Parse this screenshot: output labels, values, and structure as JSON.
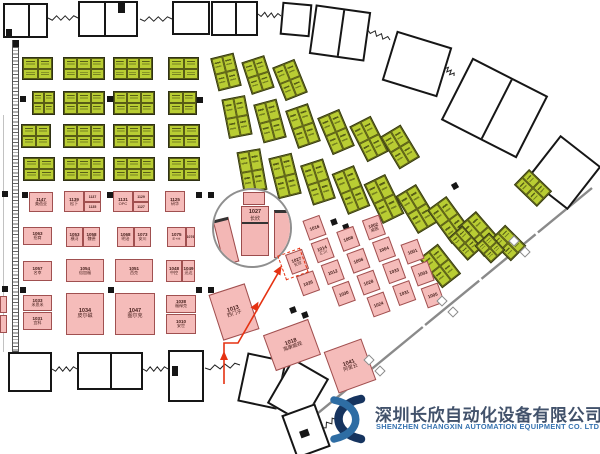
{
  "company": {
    "name_cn": "深圳长欣自动化设备有限公司",
    "name_en": "SHENZHEN CHANGXIN AUTOMATION EQUIPMENT CO. LTD"
  },
  "colors": {
    "green_booth": "#b9cd33",
    "pink_booth": "#f5bcba",
    "route_red": "#e53212",
    "wall_black": "#161616",
    "barrier_gray": "#8a8a8a",
    "logo_navy": "#16345f",
    "logo_blue": "#2e6da4"
  },
  "magnifier": {
    "cx": 252,
    "cy": 228,
    "r": 40,
    "booth_num": "1027",
    "booth_name": "长欣"
  },
  "highlight": {
    "x": 281,
    "y": 251,
    "w": 24,
    "h": 26,
    "rot": -20,
    "num": "1027",
    "name": "长欣"
  },
  "route": {
    "points": "224,384 224,343 238,343 281,268",
    "arrows": [
      {
        "x": 224,
        "y": 356,
        "a": -90
      },
      {
        "x": 256,
        "y": 306,
        "a": -60
      },
      {
        "x": 279,
        "y": 270,
        "a": -60
      }
    ]
  },
  "barrier": {
    "x1": 592,
    "y1": 188,
    "x2": 312,
    "y2": 418
  },
  "diamonds": [
    [
      514,
      241
    ],
    [
      525,
      252
    ],
    [
      442,
      301
    ],
    [
      453,
      312
    ],
    [
      369,
      360
    ],
    [
      380,
      371
    ]
  ],
  "hatch_strip": {
    "x": 12,
    "y": 40,
    "w": 7,
    "h": 312
  },
  "vlines": [
    {
      "x": 3,
      "y": 115,
      "h": 237
    }
  ],
  "rooms": [
    {
      "x": 3,
      "y": 3,
      "w": 45,
      "h": 35,
      "rot": 0,
      "div": 0.55
    },
    {
      "x": 78,
      "y": 1,
      "w": 60,
      "h": 36,
      "rot": 0,
      "div": 0.42
    },
    {
      "x": 172,
      "y": 1,
      "w": 38,
      "h": 34,
      "rot": 0
    },
    {
      "x": 211,
      "y": 1,
      "w": 47,
      "h": 35,
      "rot": 0,
      "div": 0.5
    },
    {
      "x": 281,
      "y": 3,
      "w": 30,
      "h": 33,
      "rot": 5
    },
    {
      "x": 312,
      "y": 8,
      "w": 56,
      "h": 50,
      "rot": 8,
      "div": 0.5
    },
    {
      "x": 388,
      "y": 38,
      "w": 58,
      "h": 52,
      "rot": 17
    },
    {
      "x": 452,
      "y": 73,
      "w": 85,
      "h": 70,
      "rot": 27,
      "div": 0.52
    },
    {
      "x": 538,
      "y": 145,
      "w": 52,
      "h": 55,
      "rot": 38
    },
    {
      "x": 8,
      "y": 352,
      "w": 44,
      "h": 40,
      "rot": 0
    },
    {
      "x": 77,
      "y": 352,
      "w": 66,
      "h": 38,
      "rot": 0,
      "div": 0.5
    },
    {
      "x": 168,
      "y": 350,
      "w": 36,
      "h": 52,
      "rot": 0
    },
    {
      "x": 242,
      "y": 356,
      "w": 40,
      "h": 50,
      "rot": 12
    },
    {
      "x": 277,
      "y": 365,
      "w": 42,
      "h": 52,
      "rot": 30
    },
    {
      "x": 288,
      "y": 408,
      "w": 36,
      "h": 46,
      "rot": -20
    }
  ],
  "blackbits": [
    [
      118,
      3,
      7,
      10,
      0
    ],
    [
      6,
      29,
      6,
      8,
      0
    ],
    [
      172,
      366,
      6,
      10,
      0
    ],
    [
      300,
      430,
      9,
      7,
      -20
    ],
    [
      13,
      40,
      6,
      7,
      0
    ]
  ],
  "zigzags": [
    [
      48,
      18,
      78,
      18
    ],
    [
      140,
      19,
      172,
      19
    ],
    [
      258,
      14,
      281,
      16
    ],
    [
      368,
      30,
      390,
      40
    ],
    [
      444,
      66,
      454,
      76
    ],
    [
      52,
      369,
      77,
      369
    ],
    [
      143,
      369,
      168,
      369
    ],
    [
      205,
      368,
      240,
      365
    ],
    [
      322,
      428,
      342,
      414
    ]
  ],
  "pillars": [
    [
      20,
      96,
      0
    ],
    [
      107,
      96,
      0
    ],
    [
      197,
      97,
      0
    ],
    [
      2,
      191,
      0
    ],
    [
      22,
      192,
      0
    ],
    [
      107,
      192,
      0
    ],
    [
      196,
      192,
      0
    ],
    [
      208,
      192,
      0
    ],
    [
      2,
      286,
      0
    ],
    [
      20,
      287,
      0
    ],
    [
      108,
      287,
      0
    ],
    [
      196,
      287,
      0
    ],
    [
      208,
      287,
      0
    ],
    [
      295,
      112,
      -20
    ],
    [
      372,
      132,
      -25
    ],
    [
      384,
      142,
      -25
    ],
    [
      452,
      183,
      -30
    ],
    [
      331,
      219,
      -20
    ],
    [
      343,
      224,
      -20
    ],
    [
      290,
      307,
      -20
    ],
    [
      302,
      312,
      -20
    ]
  ],
  "grid_green": [
    [
      22,
      57,
      31,
      23
    ],
    [
      63,
      57,
      42,
      23
    ],
    [
      113,
      57,
      40,
      23
    ],
    [
      168,
      57,
      31,
      23
    ],
    [
      32,
      91,
      23,
      24
    ],
    [
      63,
      91,
      42,
      24
    ],
    [
      113,
      91,
      42,
      24
    ],
    [
      168,
      91,
      29,
      24
    ],
    [
      21,
      124,
      30,
      24
    ],
    [
      63,
      124,
      42,
      24
    ],
    [
      113,
      124,
      42,
      24
    ],
    [
      168,
      124,
      32,
      24
    ],
    [
      23,
      157,
      32,
      24
    ],
    [
      63,
      157,
      42,
      24
    ],
    [
      113,
      157,
      42,
      24
    ],
    [
      168,
      157,
      32,
      24
    ]
  ],
  "fan_green": [
    [
      214,
      55,
      24,
      34,
      -14
    ],
    [
      246,
      58,
      24,
      34,
      -18
    ],
    [
      278,
      62,
      24,
      36,
      -22
    ],
    [
      225,
      97,
      24,
      40,
      -11
    ],
    [
      258,
      101,
      24,
      40,
      -15
    ],
    [
      291,
      106,
      24,
      40,
      -19
    ],
    [
      324,
      112,
      24,
      40,
      -23
    ],
    [
      357,
      119,
      24,
      40,
      -27
    ],
    [
      388,
      128,
      24,
      38,
      -31
    ],
    [
      240,
      150,
      24,
      42,
      -10
    ],
    [
      273,
      155,
      24,
      42,
      -14
    ],
    [
      306,
      161,
      24,
      42,
      -18
    ],
    [
      339,
      168,
      24,
      44,
      -22
    ],
    [
      372,
      177,
      24,
      44,
      -26
    ],
    [
      405,
      187,
      24,
      44,
      -31
    ],
    [
      437,
      199,
      24,
      42,
      -36
    ],
    [
      468,
      214,
      24,
      40,
      -41
    ],
    [
      497,
      228,
      22,
      30,
      -45
    ],
    [
      428,
      247,
      24,
      38,
      -38
    ],
    [
      455,
      228,
      20,
      30,
      -42
    ],
    [
      522,
      172,
      22,
      32,
      -46
    ],
    [
      480,
      236,
      20,
      24,
      -43
    ]
  ],
  "pink_rows": [
    {
      "x": 29,
      "y": 192,
      "w": 24,
      "h": 20,
      "num": "1147",
      "name": "美蓓亚"
    },
    {
      "x": 64,
      "y": 191,
      "w": 20,
      "h": 21,
      "num": "1139",
      "name": "松下"
    },
    {
      "x": 84,
      "y": 191,
      "w": 17,
      "h": 11,
      "num": "1137",
      "name": "",
      "tiny": true
    },
    {
      "x": 84,
      "y": 202,
      "w": 17,
      "h": 10,
      "num": "1135",
      "name": "",
      "tiny": true
    },
    {
      "x": 113,
      "y": 191,
      "w": 20,
      "h": 21,
      "num": "1131",
      "name": "OPC"
    },
    {
      "x": 133,
      "y": 191,
      "w": 16,
      "h": 11,
      "num": "1129",
      "name": "",
      "tiny": true
    },
    {
      "x": 133,
      "y": 202,
      "w": 16,
      "h": 10,
      "num": "1127",
      "name": "",
      "tiny": true
    },
    {
      "x": 165,
      "y": 191,
      "w": 20,
      "h": 21,
      "num": "1125",
      "name": "研华"
    },
    {
      "x": 23,
      "y": 227,
      "w": 29,
      "h": 18,
      "num": "1063",
      "name": "招商"
    },
    {
      "x": 66,
      "y": 227,
      "w": 17,
      "h": 20,
      "num": "1053",
      "name": "横河"
    },
    {
      "x": 83,
      "y": 227,
      "w": 17,
      "h": 20,
      "num": "1058",
      "name": "魏德"
    },
    {
      "x": 117,
      "y": 227,
      "w": 17,
      "h": 20,
      "num": "1068",
      "name": "明治"
    },
    {
      "x": 134,
      "y": 227,
      "w": 17,
      "h": 20,
      "num": "1073",
      "name": "安川"
    },
    {
      "x": 167,
      "y": 227,
      "w": 19,
      "h": 20,
      "num": "1075",
      "name": "E+H"
    },
    {
      "x": 186,
      "y": 227,
      "w": 9,
      "h": 20,
      "num": "1076",
      "name": "",
      "tiny": true
    },
    {
      "x": 23,
      "y": 261,
      "w": 29,
      "h": 20,
      "num": "1057",
      "name": "名幸"
    },
    {
      "x": 66,
      "y": 259,
      "w": 38,
      "h": 23,
      "num": "1054",
      "name": "倍加福"
    },
    {
      "x": 115,
      "y": 259,
      "w": 38,
      "h": 23,
      "num": "1051",
      "name": "西克"
    },
    {
      "x": 166,
      "y": 260,
      "w": 16,
      "h": 22,
      "num": "1048",
      "name": "中控"
    },
    {
      "x": 182,
      "y": 260,
      "w": 13,
      "h": 22,
      "num": "1049",
      "name": "迅达"
    },
    {
      "x": 23,
      "y": 295,
      "w": 29,
      "h": 16,
      "num": "1033",
      "name": "米思米"
    },
    {
      "x": 23,
      "y": 312,
      "w": 29,
      "h": 18,
      "num": "1031",
      "name": "宜科"
    },
    {
      "x": 66,
      "y": 293,
      "w": 38,
      "h": 42,
      "num": "1034",
      "name": "皮尔磁",
      "big": true
    },
    {
      "x": 115,
      "y": 293,
      "w": 40,
      "h": 42,
      "num": "1047",
      "name": "图尔克",
      "big": true
    },
    {
      "x": 166,
      "y": 295,
      "w": 30,
      "h": 18,
      "num": "1038",
      "name": "福禄克"
    },
    {
      "x": 166,
      "y": 314,
      "w": 30,
      "h": 20,
      "num": "1010",
      "name": "安世"
    },
    {
      "x": 0,
      "y": 296,
      "w": 7,
      "h": 17,
      "num": "",
      "name": "",
      "tiny": true
    },
    {
      "x": 0,
      "y": 315,
      "w": 7,
      "h": 18,
      "num": "",
      "name": "",
      "tiny": true
    }
  ],
  "pink_cluster": {
    "origin_x": 285,
    "origin_y": 255,
    "rot": -20,
    "bw": 18,
    "bh": 21,
    "booths": [
      {
        "lx": 3,
        "ly": 24,
        "num": "1026",
        "name": ""
      },
      {
        "lx": 28,
        "ly": -26,
        "num": "1016",
        "name": ""
      },
      {
        "lx": 28,
        "ly": -2,
        "num": "1014",
        "name": "汇川"
      },
      {
        "lx": 30,
        "ly": 22,
        "num": "1012",
        "name": ""
      },
      {
        "lx": 33,
        "ly": 46,
        "num": "1030",
        "name": ""
      },
      {
        "lx": 56,
        "ly": -4,
        "num": "1008",
        "name": ""
      },
      {
        "lx": 58,
        "ly": 20,
        "num": "1006",
        "name": ""
      },
      {
        "lx": 60,
        "ly": 44,
        "num": "1028",
        "name": ""
      },
      {
        "lx": 62,
        "ly": 68,
        "num": "1024",
        "name": ""
      },
      {
        "lx": 84,
        "ly": -6,
        "num": "1002",
        "name": "威图"
      },
      {
        "lx": 86,
        "ly": 18,
        "num": "1004",
        "name": ""
      },
      {
        "lx": 88,
        "ly": 42,
        "num": "1033",
        "name": ""
      },
      {
        "lx": 90,
        "ly": 66,
        "num": "1031",
        "name": ""
      },
      {
        "lx": 112,
        "ly": 30,
        "num": "1001",
        "name": ""
      },
      {
        "lx": 114,
        "ly": 54,
        "num": "1003",
        "name": ""
      },
      {
        "lx": 116,
        "ly": 78,
        "num": "1005",
        "name": ""
      }
    ],
    "highlight_booth": {
      "lx": 0,
      "ly": 0,
      "num": "1027",
      "name": "长欣"
    }
  },
  "big_pink": [
    {
      "x": 215,
      "y": 288,
      "w": 38,
      "h": 48,
      "rot": -18,
      "num": "1013",
      "name": "西门子"
    },
    {
      "x": 268,
      "y": 326,
      "w": 48,
      "h": 38,
      "rot": -20,
      "num": "1018",
      "name": "海康威视"
    },
    {
      "x": 330,
      "y": 344,
      "w": 40,
      "h": 44,
      "rot": -20,
      "num": "1041",
      "name": "阿里云"
    }
  ],
  "mag_inner": {
    "left_booth": {
      "x": 4,
      "y": 28,
      "w": 16,
      "h": 46,
      "rot": -14
    },
    "center_top": {
      "x": 29,
      "y": 2,
      "w": 22,
      "h": 13
    },
    "center_booth": {
      "x": 27,
      "y": 16,
      "w": 28,
      "h": 50
    },
    "right_booth": {
      "x": 60,
      "y": 20,
      "w": 18,
      "h": 48
    }
  }
}
